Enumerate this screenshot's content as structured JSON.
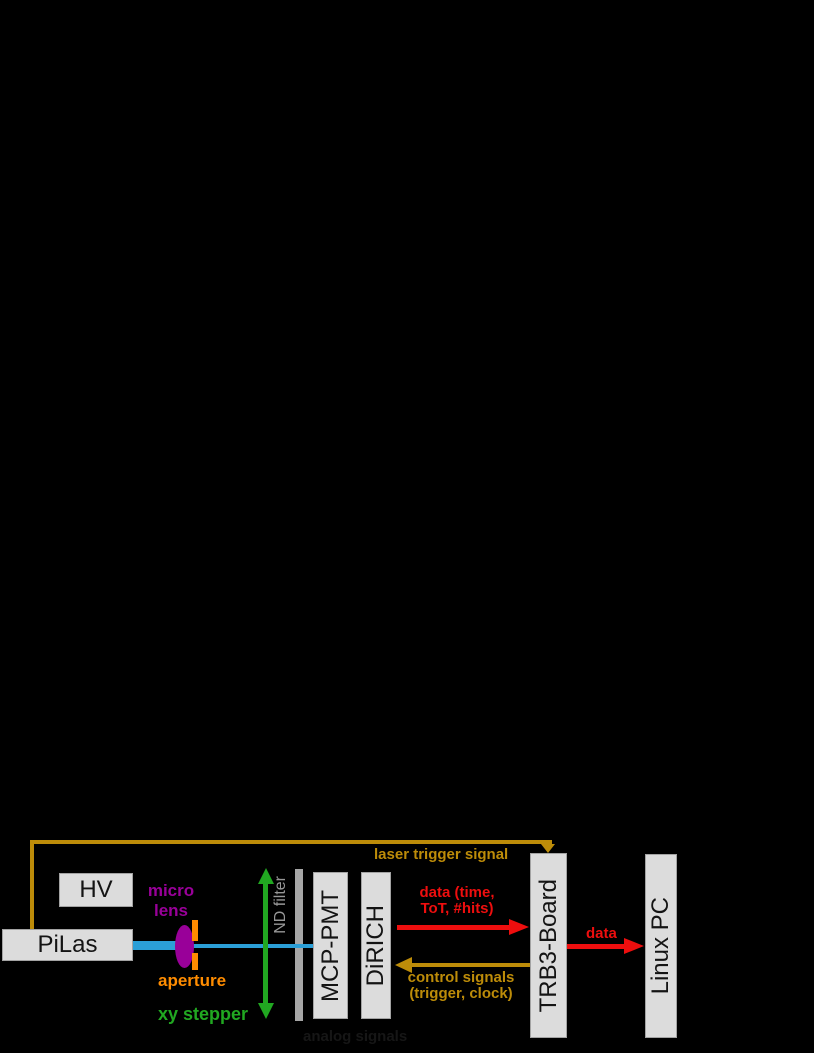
{
  "colors": {
    "background": "#000000",
    "gold": "#bd8c09",
    "red": "#ee0e0e",
    "green": "#21a821",
    "purple": "#990099",
    "orange": "#ff8c00",
    "blue": "#2b9fd7",
    "bar-gray": "#a6a6a6",
    "label-gray": "#979797",
    "box-fill": "#dcdcdc",
    "box-border": "#a3a3a3",
    "box-text": "#141414",
    "faint-text": "#161616"
  },
  "boxes": {
    "hv": {
      "label": "HV"
    },
    "pilas": {
      "label": "PiLas"
    },
    "mcp_pmt": {
      "label": "MCP-PMT"
    },
    "dirich": {
      "label": "DiRICH"
    },
    "trb3_board": {
      "label": "TRB3-Board"
    },
    "linux_pc": {
      "label": "Linux PC"
    }
  },
  "annotations": {
    "laser_trigger_signal": "laser trigger signal",
    "micro_lens_line1": "micro",
    "micro_lens_line2": "lens",
    "aperture": "aperture",
    "nd_filter": "ND filter",
    "xy_stepper": "xy stepper",
    "data_to_trb_line1": "data (time,",
    "data_to_trb_line2": "ToT, #hits)",
    "control_signals_line1": "control signals",
    "control_signals_line2": "(trigger, clock)",
    "data_to_pc": "data",
    "analog_signals": "analog signals"
  }
}
